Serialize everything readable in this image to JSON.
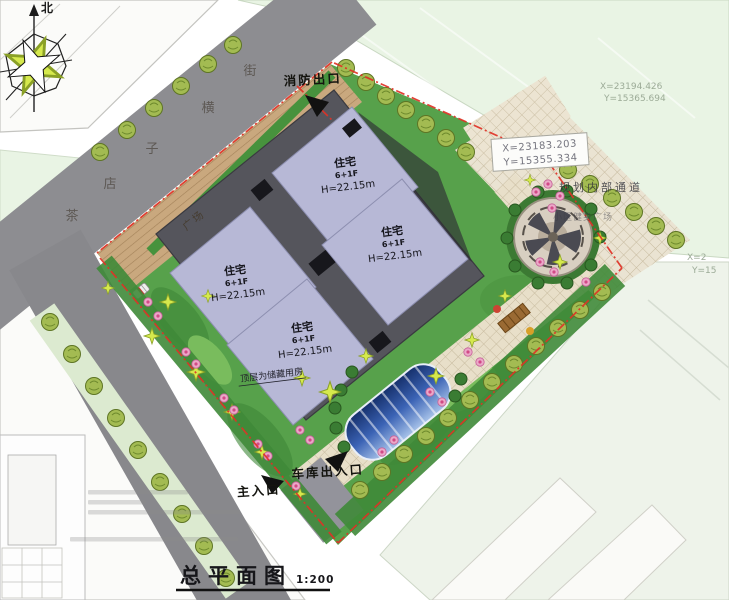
{
  "drawing": {
    "title": "总平面图",
    "scale": "1:200"
  },
  "compass": {
    "north": "北"
  },
  "street": {
    "name": "茶店子横街",
    "chars": [
      "茶",
      "店",
      "子",
      "横",
      "街"
    ]
  },
  "entrances": {
    "fire_exit": "消防出口",
    "garage": "车库出入口",
    "main": "主入口"
  },
  "site": {
    "plaza_label": "广场",
    "internal_road_label": "规划内部通道",
    "fitness_label": "小区健身广场",
    "roof_note": "顶层为储藏用房"
  },
  "buildings": [
    {
      "name": "住宅",
      "floors": "6+1F",
      "height": "H=22.15m"
    },
    {
      "name": "住宅",
      "floors": "6+1F",
      "height": "H=22.15m"
    },
    {
      "name": "住宅",
      "floors": "6+1F",
      "height": "H=22.15m"
    },
    {
      "name": "住宅",
      "floors": "6+1F",
      "height": "H=22.15m"
    }
  ],
  "survey_points": {
    "boxed": {
      "x": "X=23183.203",
      "y": "Y=15355.334"
    },
    "faint": {
      "x": "X=23194.426",
      "y": "Y=15365.694"
    },
    "edge": {
      "x": "X=2",
      "y": "Y=15"
    }
  },
  "colors": {
    "boundary_red": "#e03226",
    "road_gray": "#8d8d91",
    "building_lavender": "#b7b8d6",
    "podium_gray": "#55555c",
    "landscape_green": "#57a14b",
    "parking_tan": "#c9a87e",
    "walkway_tan": "#e8dfc9",
    "canopy_blue": "#2a4fa0",
    "parcel_green": "#e9f4e4"
  }
}
